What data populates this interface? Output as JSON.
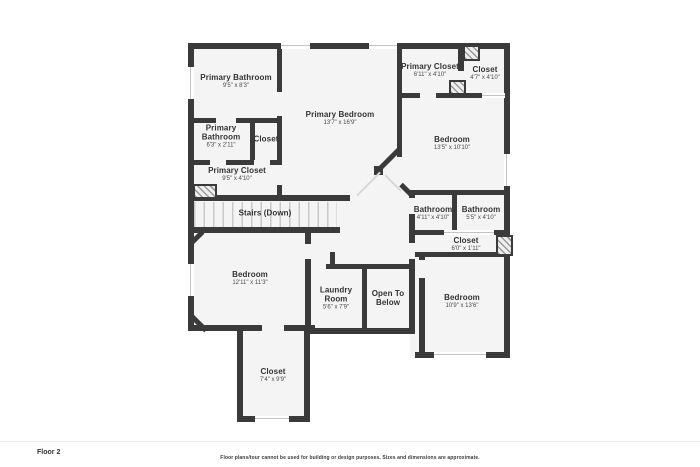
{
  "floor_plan": {
    "colors": {
      "wall": "#3a3a3a",
      "floor": "#f4f4f4"
    },
    "rooms": [
      {
        "name": "Primary Bathroom",
        "dims": "9'5\" x 8'3\""
      },
      {
        "name": "Primary Bedroom",
        "dims": "13'7\" x 16'9\""
      },
      {
        "name": "Primary Closet",
        "dims": "6'11\" x 4'10\""
      },
      {
        "name": "Closet",
        "dims": "4'7\" x 4'10\""
      },
      {
        "name": "Bedroom",
        "dims": "13'5\" x 10'10\""
      },
      {
        "name": "Primary Bathroom",
        "dims": "6'3\" x 2'11\""
      },
      {
        "name": "Closet"
      },
      {
        "name": "Primary Closet",
        "dims": "9'5\" x 4'10\""
      },
      {
        "name": "Stairs (Down)"
      },
      {
        "name": "Bathroom",
        "dims": "4'11\" x 4'10\""
      },
      {
        "name": "Bathroom",
        "dims": "5'5\" x 4'10\""
      },
      {
        "name": "Closet",
        "dims": "6'0\" x 1'11\""
      },
      {
        "name": "Bedroom",
        "dims": "12'11\" x 11'3\""
      },
      {
        "name": "Laundry Room",
        "dims": "5'6\" x 7'9\""
      },
      {
        "name": "Open To Below"
      },
      {
        "name": "Bedroom",
        "dims": "10'9\" x 13'6\""
      },
      {
        "name": "Closet",
        "dims": "7'4\" x 9'9\""
      }
    ]
  },
  "footer": {
    "floor_label": "Floor 2",
    "disclaimer": "Floor plans/tour cannot be used for building or design purposes. Sizes and dimensions are approximate."
  }
}
